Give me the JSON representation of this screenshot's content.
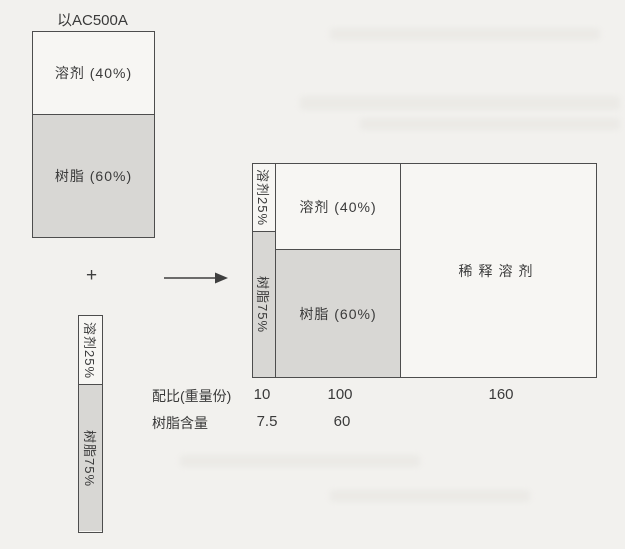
{
  "page": {
    "title": "以AC500A",
    "plus": "+",
    "base_mix_box": {
      "solvent": {
        "label": "溶剂 (40%)",
        "percent": 40
      },
      "resin": {
        "label": "树脂 (60%)",
        "percent": 60
      }
    },
    "curing_agent_bar": {
      "solvent": {
        "label": "溶剂25%",
        "percent": 25
      },
      "resin": {
        "label": "树脂75%",
        "percent": 75
      }
    },
    "result_box": {
      "agent_column": {
        "solvent": {
          "label": "溶剂25%"
        },
        "resin": {
          "label": "树脂75%"
        }
      },
      "base_column": {
        "solvent": {
          "label": "溶剂 (40%)"
        },
        "resin": {
          "label": "树脂 (60%)"
        }
      },
      "diluent": {
        "label": "稀释溶剂"
      }
    },
    "ratio_table": {
      "rows": [
        {
          "label": "配比(重量份)",
          "values": [
            "10",
            "100",
            "160"
          ]
        },
        {
          "label": "树脂含量",
          "values": [
            "7.5",
            "60"
          ]
        }
      ]
    },
    "colors": {
      "paper": "#f2f1ee",
      "white_fill": "#f7f6f3",
      "gray_fill": "#d8d7d4",
      "line": "#4d4d4d",
      "text": "#3a3a3a"
    }
  }
}
